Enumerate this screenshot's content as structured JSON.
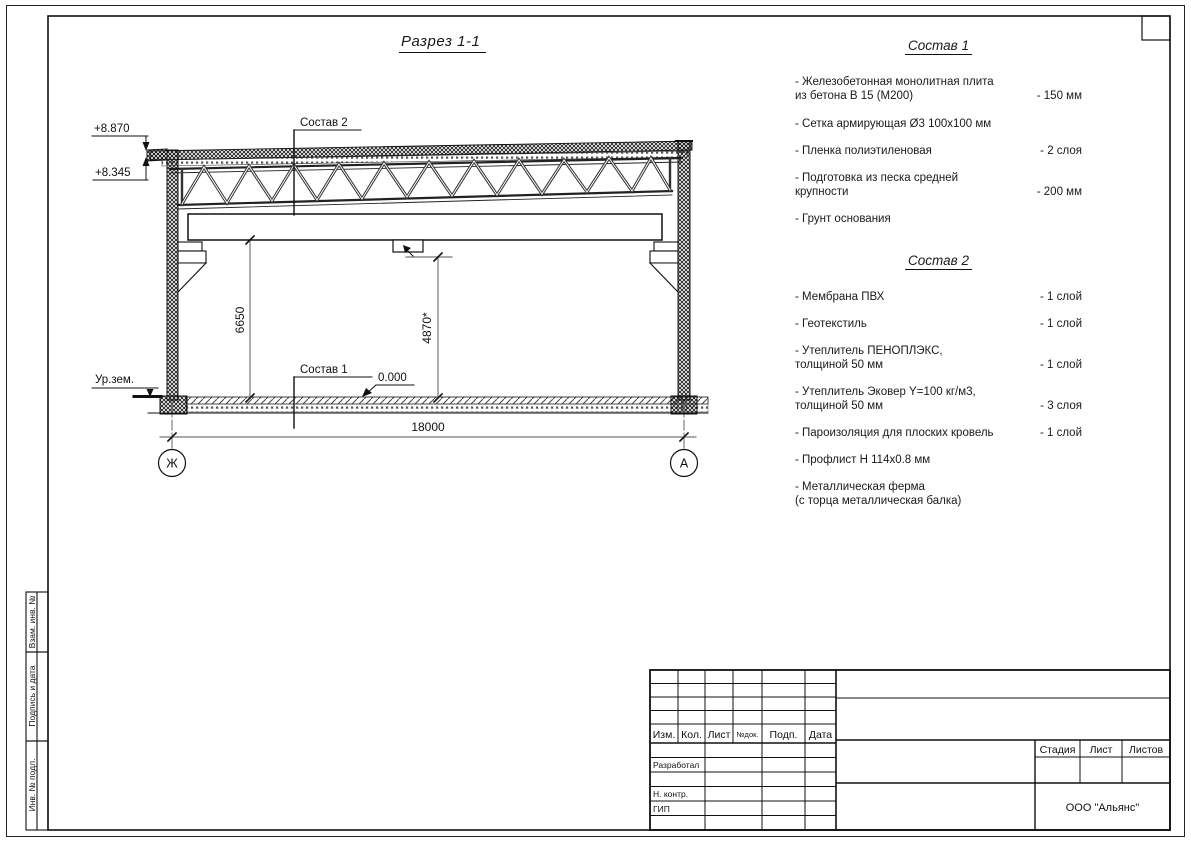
{
  "colors": {
    "ink": "#1a1a1a",
    "dim_line": "#777777"
  },
  "drawing": {
    "title": "Разрез 1-1",
    "elevations": {
      "parapet": "+8.870",
      "roof_edge": "+8.345"
    },
    "ground_label": "Ур.зем.",
    "zero_level": "0.000",
    "callouts": {
      "roof": "Состав 2",
      "floor": "Состав 1"
    },
    "dimensions": {
      "beam_height": "6650",
      "clear_height": "4870*",
      "span": "18000"
    },
    "axes": {
      "left": "Ж",
      "right": "А"
    }
  },
  "sostav1": {
    "title": "Состав 1",
    "items": [
      {
        "name": "- Железобетонная  монолитная плита\nиз бетона В 15 (М200)",
        "value": "- 150 мм"
      },
      {
        "name": "- Сетка армирующая Ø3 100х100 мм",
        "value": ""
      },
      {
        "name": "- Пленка полиэтиленовая",
        "value": "- 2 слоя"
      },
      {
        "name": "- Подготовка из песка средней\nкрупности",
        "value": "- 200 мм"
      },
      {
        "name": "- Грунт основания",
        "value": ""
      }
    ]
  },
  "sostav2": {
    "title": "Состав 2",
    "items": [
      {
        "name": "- Мембрана ПВХ",
        "value": "- 1 слой"
      },
      {
        "name": "- Геотекстиль",
        "value": "- 1 слой"
      },
      {
        "name": "- Утеплитель ПЕНОПЛЭКС,\nтолщиной 50 мм",
        "value": "- 1 слой"
      },
      {
        "name": "- Утеплитель Эковер Y=100 кг/м3,\nтолщиной 50 мм",
        "value": "- 3 слоя"
      },
      {
        "name": "- Пароизоляция для плоских кровель",
        "value": "- 1 слой"
      },
      {
        "name": "- Профлист Н 114х0.8 мм",
        "value": ""
      },
      {
        "name": "- Металлическая ферма\n(с торца металлическая балка)",
        "value": ""
      }
    ]
  },
  "titleblock": {
    "columns": {
      "izm": "Изм.",
      "kol": "Кол.",
      "list": "Лист",
      "ndok": "№док.",
      "podp": "Подп.",
      "data": "Дата"
    },
    "roles": {
      "developer": "Разработал",
      "ncontrol": "Н. контр.",
      "gip": "ГИП"
    },
    "stage": {
      "stadia": "Стадия",
      "list": "Лист",
      "listov": "Листов"
    },
    "company": "ООО \"Альянс\""
  },
  "sidebar": {
    "vzam": "Взам. инв. №",
    "podpis": "Подпись и дата",
    "inv": "Инв. № подл."
  }
}
